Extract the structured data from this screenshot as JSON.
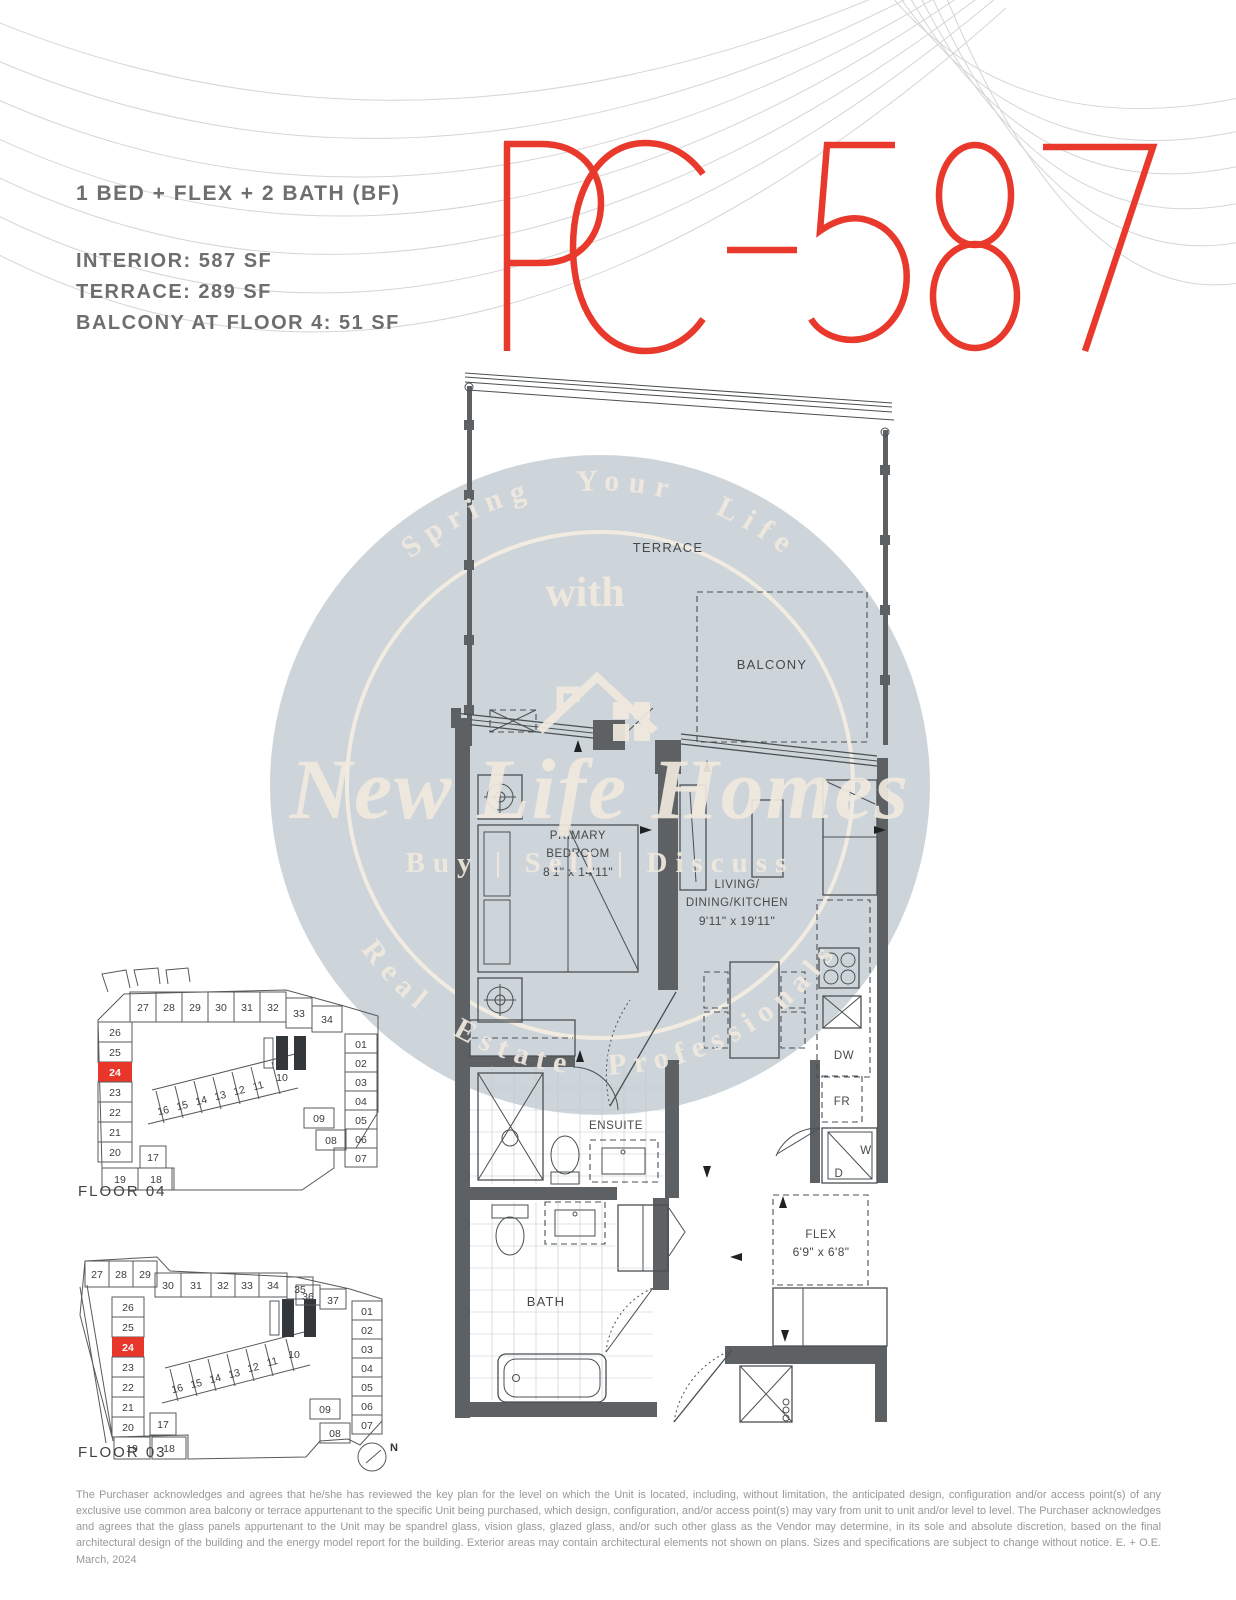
{
  "header": {
    "unit_type": "1 BED + FLEX + 2 BATH (BF)",
    "spec_interior": "INTERIOR:  587 SF",
    "spec_terrace": "TERRACE:   289 SF",
    "spec_balcony": "BALCONY AT FLOOR 4: 51 SF",
    "unit_code": "PC-587",
    "accent_color": "#e8392c"
  },
  "watermark": {
    "arc_top": "Spring Your Life",
    "middle_word": "with",
    "brand": "New Life Homes",
    "tagline": "Buy | Sell | Discuss",
    "arc_bottom": "Real Estate Professionals",
    "circle_color": "#cdd5da",
    "text_color": "#f0e9df"
  },
  "floorplan": {
    "rooms": {
      "terrace": "TERRACE",
      "balcony": "BALCONY",
      "bedroom_line1": "PRIMARY",
      "bedroom_line2": "BEDROOM",
      "bedroom_dims": "8'1\" x 14'11\"",
      "living_line1": "LIVING/",
      "living_line2": "DINING/KITCHEN",
      "living_dims": "9'11\" x 19'11\"",
      "ensuite": "ENSUITE",
      "bath": "BATH",
      "flex": "FLEX",
      "flex_dims": "6'9\" x 6'8\""
    },
    "appliances": {
      "dishwasher": "DW",
      "fridge": "FR",
      "washer": "W",
      "dryer": "D"
    }
  },
  "keyplans": [
    {
      "floor_label": "FLOOR 04",
      "highlighted_unit": "24",
      "top_row": [
        "27",
        "28",
        "29",
        "30",
        "31",
        "32",
        "33",
        "34"
      ],
      "left_column": [
        "26",
        "25",
        "24",
        "23",
        "22",
        "21",
        "20"
      ],
      "bottom_left": [
        "19",
        "18"
      ],
      "corner_unit": "17",
      "middle_row": [
        "16",
        "15",
        "14",
        "13",
        "12",
        "11",
        "10"
      ],
      "right_column": [
        "01",
        "02",
        "03",
        "04",
        "05",
        "06",
        "07"
      ],
      "lower_right": [
        "09",
        "08"
      ]
    },
    {
      "floor_label": "FLOOR 03",
      "highlighted_unit": "24",
      "top_left_block": [
        "27",
        "28",
        "29"
      ],
      "top_row": [
        "30",
        "31",
        "32",
        "33",
        "34",
        "35",
        "36",
        "37"
      ],
      "left_column": [
        "26",
        "25",
        "24",
        "23",
        "22",
        "21",
        "20"
      ],
      "bottom_left": [
        "19",
        "18"
      ],
      "corner_unit": "17",
      "middle_row": [
        "16",
        "15",
        "14",
        "13",
        "12",
        "11",
        "10"
      ],
      "right_column": [
        "01",
        "02",
        "03",
        "04",
        "05",
        "06",
        "07"
      ],
      "lower_right": [
        "09",
        "08"
      ],
      "compass": "N"
    }
  ],
  "disclaimer": "The Purchaser acknowledges and agrees that he/she has reviewed the key plan for the level on which the Unit is located, including, without limitation, the anticipated design, configuration and/or access point(s) of any exclusive use common area balcony or terrace appurtenant to the specific Unit being purchased, which design, configuration, and/or access point(s) may vary from unit to unit and/or level to level. The Purchaser acknowledges and agrees that the glass panels appurtenant to the Unit may be spandrel glass, vision glass, glazed glass, and/or such other glass as the Vendor may determine, in its sole and absolute discretion, based on the final architectural design of the building and the energy model report for the building. Exterior areas may contain architectural elements not shown on plans. Sizes and specifications are subject to change without notice. E. + O.E. March, 2024"
}
